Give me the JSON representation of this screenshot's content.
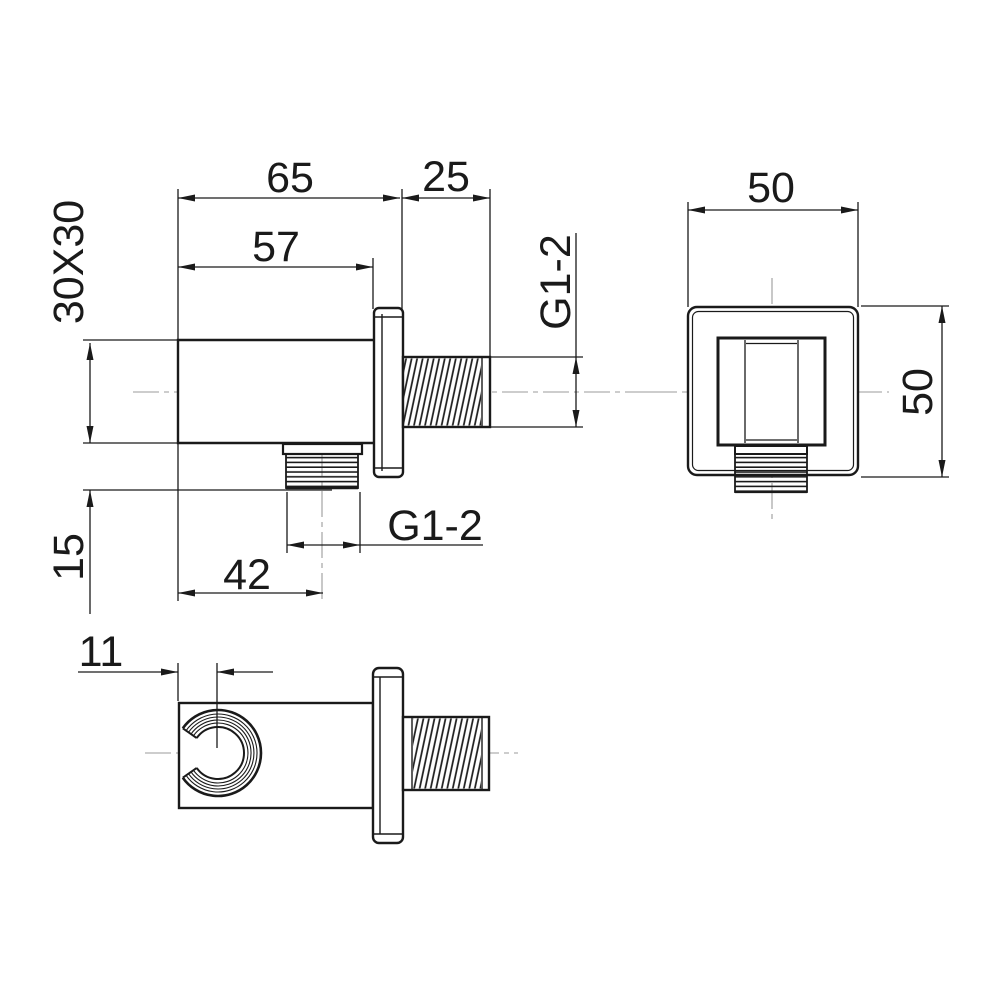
{
  "drawing": {
    "side_view": {
      "dim_overall_depth": "65",
      "dim_body_depth": "57",
      "dim_wall_thread_length": "25",
      "dim_body_section": "30X30",
      "dim_outlet_drop": "15",
      "dim_outlet_offset": "42",
      "wall_thread_label": "G1-2",
      "outlet_thread_label": "G1-2"
    },
    "front_view": {
      "dim_width": "50",
      "dim_height": "50"
    },
    "bottom_view": {
      "dim_holder_offset": "11"
    },
    "colors": {
      "line": "#1a1a1a",
      "centerline": "#9b9b9b",
      "background": "#ffffff"
    }
  }
}
